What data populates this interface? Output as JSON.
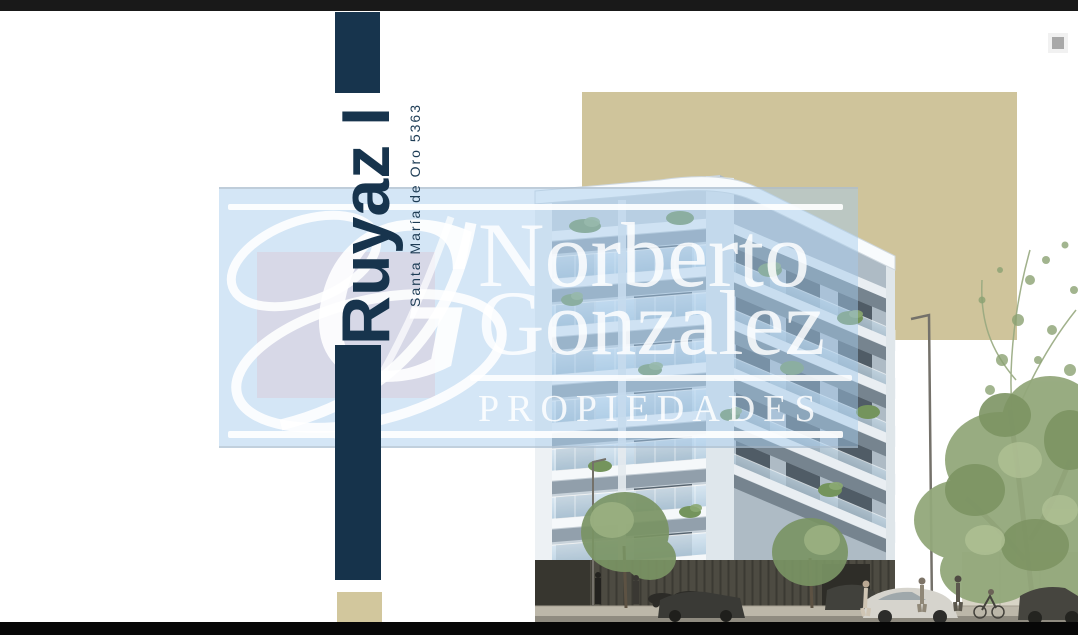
{
  "branding": {
    "project_title": "Ruyaz I",
    "address": "Santa María de Oro 5363",
    "navy": "#17344d",
    "tan": "#cfc49b"
  },
  "watermark": {
    "monogram": "G",
    "name_line1": "Norberto",
    "name_line2": "Gonzalez",
    "tagline": "PROPIEDADES",
    "panel_tint": "#cfe3f6"
  },
  "frame": {
    "top_bar_color": "#191919",
    "bottom_bar_color": "#070707",
    "artifact_square_color": "#a8a8a8"
  }
}
